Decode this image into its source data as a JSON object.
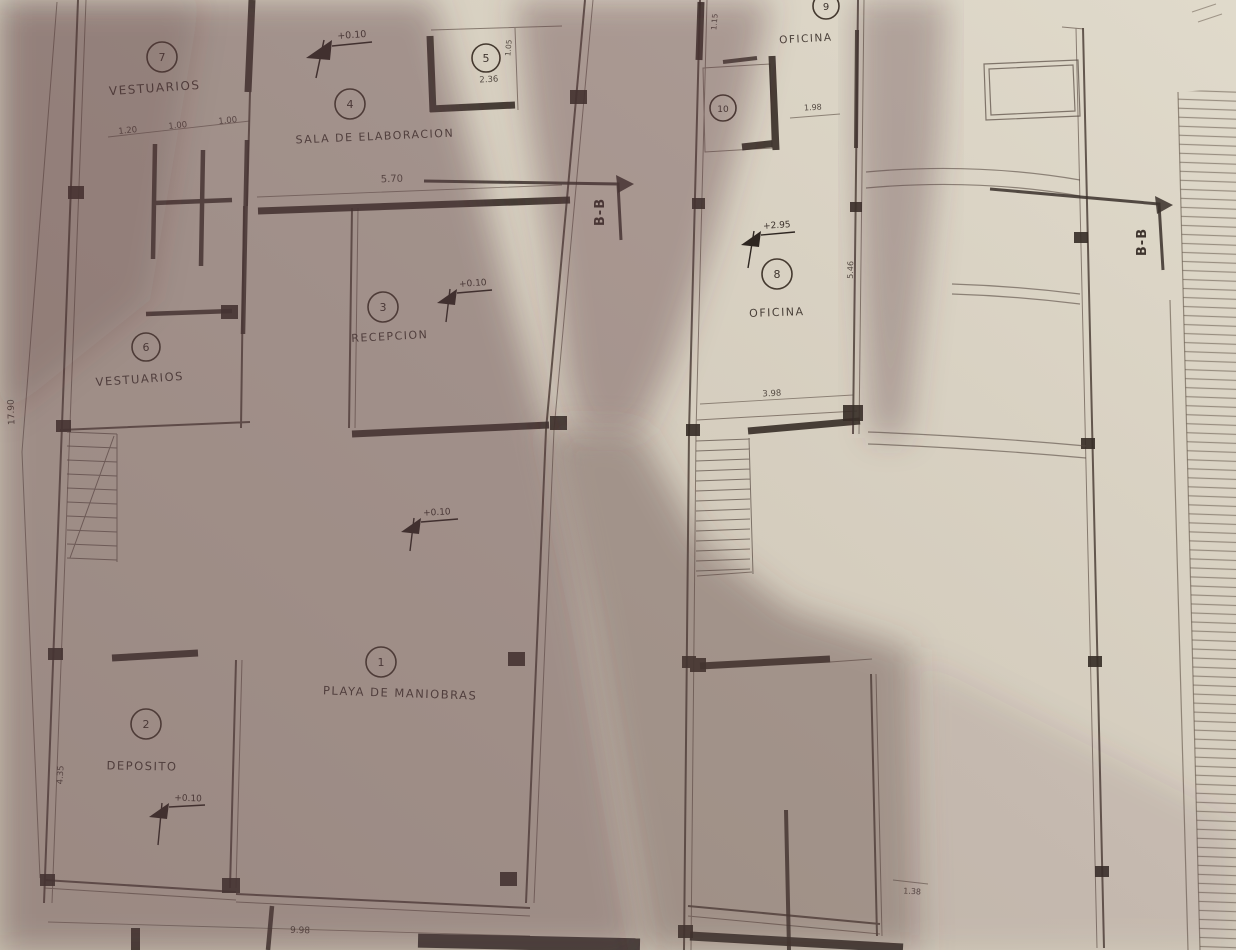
{
  "photo": {
    "description": "hand-drafted architectural floor plan on paper, partly in shadow"
  },
  "left_plan": {
    "rooms": {
      "r7": {
        "num": "7",
        "label": "VESTUARIOS"
      },
      "r4": {
        "num": "4",
        "label": "SALA DE ELABORACION"
      },
      "r5": {
        "num": "5"
      },
      "r3": {
        "num": "3",
        "label": "RECEPCION"
      },
      "r6": {
        "num": "6",
        "label": "VESTUARIOS"
      },
      "r1": {
        "num": "1",
        "label": "PLAYA DE MANIOBRAS"
      },
      "r2": {
        "num": "2",
        "label": "DEPOSITO"
      }
    },
    "levels": {
      "sala": "+0.10",
      "recepcion": "+0.10",
      "playa": "+0.10",
      "deposito": "+0.10"
    },
    "dims": {
      "top1": "1.20",
      "top2": "1.00",
      "top3": "1.00",
      "sala_width": "5.70",
      "room5_width": "2.36",
      "room5_height": "1.05",
      "left_height": "17.90",
      "deposito_height": "4.35",
      "bottom_width": "9.98"
    },
    "section_label": "B-B"
  },
  "right_plan": {
    "rooms": {
      "r9": {
        "num": "9",
        "label": "OFICINA"
      },
      "r10": {
        "num": "10"
      },
      "r8": {
        "num": "8",
        "label": "OFICINA"
      }
    },
    "levels": {
      "oficina": "+2.95"
    },
    "dims": {
      "top_height": "1.15",
      "top_width": "1.98",
      "oficina_height": "5.46",
      "oficina_width": "3.98",
      "bottom": "1.38"
    },
    "section_label": "B-B"
  }
}
